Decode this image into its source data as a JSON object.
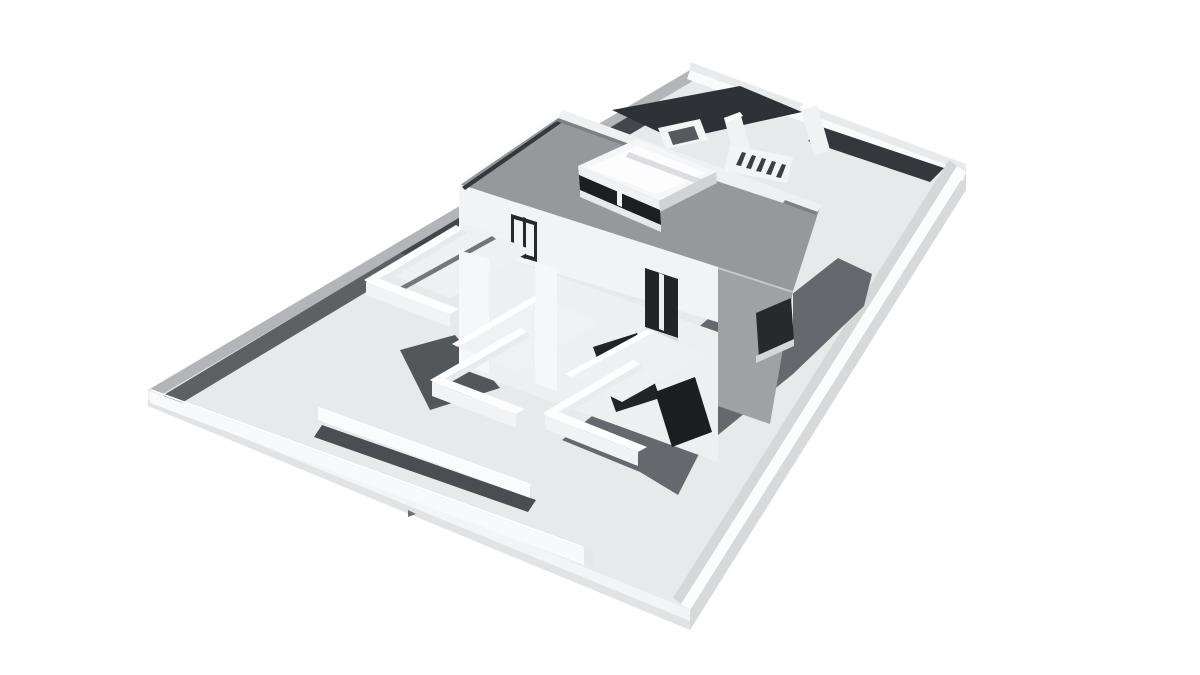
{
  "meta": {
    "title": "3D architectural massing render",
    "type": "grayscale-3d-render",
    "description": "Aerial isometric rendering of a modern two-storey flat-roof house with rooftop terrace box, stepped front balconies, interior courtyard walls, staircase, and a walled rectangular plot on a white background. No text or UI controls are visible."
  },
  "palette": {
    "background": "#ffffff",
    "ground": "#e8e9ea",
    "roof_gray": "#97989b",
    "facade_white": "#f2f3f4",
    "facade_shaded_gray": "#a0a1a5",
    "glass_dark": "#1c1e21",
    "cast_shadow": "#65686c",
    "courtyard_floor_dark": "#2e3135",
    "wall_top_gray": "#b4b5b8"
  },
  "scene": {
    "width": 1200,
    "height": 675,
    "background": "#ffffff",
    "shapes": [
      {
        "n": "plot-slab-side-right",
        "p": "690,610 966,172 966,190 690,630",
        "f": "#d8d9db"
      },
      {
        "n": "plot-slab-side-left",
        "p": "148,390 690,610 690,630 148,406",
        "f": "#f3f4f5"
      },
      {
        "n": "plot-slab-side-left-lip",
        "p": "148,399 690,621 690,630 148,406",
        "f": "#e2e3e5"
      },
      {
        "n": "plot-ground",
        "p": "148,390 690,70 966,172 690,610",
        "f": "#e8e9ea"
      },
      {
        "n": "perimeter-wall-topleft-top",
        "p": "148,390 690,70 703,75 161,395",
        "f": "#b4b5b8"
      },
      {
        "n": "perimeter-wall-topleft-shadow-lower",
        "p": "162,396 400,253 418,261 180,404",
        "f": "#5e6164"
      },
      {
        "n": "perimeter-wall-topleft-shadow-upper",
        "p": "400,253 648,105 666,113 418,261",
        "f": "#43464a"
      },
      {
        "n": "perimeter-wall-topright-top",
        "p": "690,62 966,164 966,172 690,70",
        "f": "#e9eaeb"
      },
      {
        "n": "perimeter-wall-topright-inner-face",
        "p": "690,70 966,172 963,181 687,79",
        "f": "#f9fafb"
      },
      {
        "n": "perimeter-wall-right-top",
        "p": "966,172 690,610 681,604 957,166",
        "f": "#fbfcfc"
      },
      {
        "n": "perimeter-wall-right-inner-face",
        "p": "957,166 681,604 673,598 949,160",
        "f": "#d6d7d9"
      },
      {
        "n": "courtyard-floor-dark-left",
        "p": "612,110 740,86 802,112 676,140",
        "f": "#2e3135"
      },
      {
        "n": "courtyard-floor-dark-right",
        "p": "822,127 944,168 930,182 808,141",
        "f": "#34373b"
      },
      {
        "n": "courtyard-planter-outer",
        "p": "658,128 700,119 708,140 666,149",
        "f": "#f4f5f6"
      },
      {
        "n": "courtyard-planter-inner",
        "p": "668,132 694,126 699,139 673,145",
        "f": "#565a5e"
      },
      {
        "n": "courtyard-partition-wall-a-face",
        "p": "724,118 740,112 754,164 738,170",
        "f": "#f1f2f4"
      },
      {
        "n": "courtyard-partition-wall-a-top",
        "p": "724,118 740,112 743,116 727,122",
        "f": "#ffffff"
      },
      {
        "n": "courtyard-partition-wall-b-face",
        "p": "800,106 816,100 830,150 814,156",
        "f": "#f1f2f4"
      },
      {
        "n": "courtyard-partition-wall-b-top",
        "p": "800,106 816,100 819,104 803,110",
        "f": "#ffffff"
      },
      {
        "n": "house-cast-shadow",
        "p": "562,440 650,370 718,310 791,295 838,258 872,274 864,306 793,374 702,448 678,495 640,472",
        "f": "#65686c"
      },
      {
        "n": "garden-wall-shadow-strip",
        "p": "322,425 536,500 528,512 314,437",
        "f": "#4a4d51"
      },
      {
        "n": "garden-wall-face",
        "p": "318,408 530,485 530,498 318,420",
        "f": "#fafbfc"
      },
      {
        "n": "garden-wall-top",
        "p": "316,406 528,483 532,486 320,409",
        "f": "#ffffff"
      },
      {
        "n": "perimeter-wall-bottomleft-top",
        "p": "148,388 582,546 585,549 151,391",
        "f": "#ffffff"
      },
      {
        "n": "perimeter-wall-bottomleft-face",
        "p": "150,391 584,549 584,565 150,403",
        "f": "#f8f9fa"
      },
      {
        "n": "perimeter-wall-bottomleft-endcap",
        "p": "584,547 594,551 594,566 584,562",
        "f": "#e6e7e9"
      },
      {
        "n": "perimeter-wall-gate-notch",
        "p": "408,510 416,514 408,517",
        "f": "#6e7073"
      },
      {
        "n": "terrace-ground-shadow",
        "p": "400,350 455,335 500,388 430,410",
        "f": "#54575a"
      },
      {
        "n": "house-facade-lower",
        "p": "459,242 718,332 718,462 459,368",
        "f": "#edeff1"
      },
      {
        "n": "house-glazing-ground-left",
        "p": "593,347 637,333 660,398 616,412",
        "f": "#212326"
      },
      {
        "n": "house-glazing-ground-right",
        "p": "655,392 695,377 712,432 672,447",
        "f": "#1b1d20"
      },
      {
        "n": "house-facade-upper",
        "p": "459,184 793,291 793,345 459,244",
        "f": "#f2f3f4"
      },
      {
        "n": "house-side-facade-shaded",
        "p": "718,267 793,291 770,424 718,406",
        "f": "#a0a1a5"
      },
      {
        "n": "house-side-roofline",
        "p": "718,265 793,289 793,293 718,269",
        "f": "#c6c8cb"
      },
      {
        "n": "house-side-window-dark",
        "p": "756,313 791,298 794,341 759,358",
        "f": "#27292c"
      },
      {
        "n": "house-side-window-sill",
        "p": "756,356 794,339 794,346 756,363",
        "f": "#d4d6d8"
      },
      {
        "n": "upper-door-frame",
        "p": "511,214 537,222 537,262 511,254",
        "f": "#26282b"
      },
      {
        "n": "upper-door-glass",
        "p": "514,219 534,225 534,257 514,251",
        "f": "#f2f3f5"
      },
      {
        "n": "upper-door-mullion",
        "p": "523,217 526,218 526,259 523,258",
        "f": "#26282b"
      },
      {
        "n": "upper-window-dark",
        "p": "645,268 678,279 678,338 645,327",
        "f": "#222427"
      },
      {
        "n": "upper-window-mullion",
        "p": "659,273 664,275 664,331 659,329",
        "f": "#eceded"
      },
      {
        "n": "upper-window-sill",
        "p": "645,327 678,338 678,343 645,332",
        "f": "#d9dadc"
      },
      {
        "n": "roof-top",
        "p": "459,184 563,113 820,207 793,291",
        "f": "#97989b"
      },
      {
        "n": "roof-edge-highlight-west",
        "p": "457,182 561,111 564,114 460,185",
        "f": "#fbfcfd"
      },
      {
        "n": "roof-edge-dark-line-west",
        "p": "462,187 564,116 567,119 465,190",
        "f": "#35383c"
      },
      {
        "n": "roof-parapet-northeast",
        "p": "563,110 822,205 816,214 557,119",
        "f": "#eff0f2"
      },
      {
        "n": "roof-parapet-northeast-shadowline",
        "p": "558,118 818,212 816,215 556,121",
        "f": "#7e8084"
      },
      {
        "n": "roof-rim-east-return",
        "p": "660,150 790,193 783,203 653,160",
        "f": "#eef0f2"
      },
      {
        "n": "stairs-base",
        "p": "730,145 793,157 787,183 724,171",
        "f": "#f3f4f6"
      },
      {
        "n": "stairs-step-gap-1",
        "p": "742,152 746,153 741,166 736,165",
        "f": "#3b3e42"
      },
      {
        "n": "stairs-step-gap-2",
        "p": "752,155 756,156 751,169 746,168",
        "f": "#3b3e42"
      },
      {
        "n": "stairs-step-gap-3",
        "p": "762,158 766,159 761,172 756,171",
        "f": "#3b3e42"
      },
      {
        "n": "stairs-step-gap-4",
        "p": "772,161 776,162 771,175 766,174",
        "f": "#3b3e42"
      },
      {
        "n": "stairs-step-gap-5",
        "p": "782,164 786,165 781,178 776,177",
        "f": "#3b3e42"
      },
      {
        "n": "roofbox-parapet-rim",
        "p": "578,166 637,139 716,172 659,201",
        "f": "#f5f6f8"
      },
      {
        "n": "roofbox-terrace-floor",
        "p": "587,168 637,146 706,173 657,194",
        "f": "#fdfdfe"
      },
      {
        "n": "roofbox-floor-ridge",
        "p": "629,152 701,179 698,184 626,157",
        "f": "#dcdde0"
      },
      {
        "n": "roofbox-right-face",
        "p": "659,201 716,172 717,183 660,212",
        "f": "#d2d3d6"
      },
      {
        "n": "roofbox-front-band",
        "p": "578,166 659,201 660,210 579,175",
        "f": "#f0f1f3"
      },
      {
        "n": "roofbox-front-glass",
        "p": "579,175 660,210 661,225 580,190",
        "f": "#1c1e21"
      },
      {
        "n": "roofbox-front-mullion",
        "p": "617,188 622,190 622,207 617,205",
        "f": "#f4f5f6"
      },
      {
        "n": "roofbox-front-sill",
        "p": "580,190 661,225 661,232 580,197",
        "f": "#e7e8ea"
      },
      {
        "n": "terrace1-floor",
        "p": "383,272 465,224 532,250 450,298",
        "f": "#eef0f2"
      },
      {
        "n": "terrace1-floor-shadowline",
        "p": "398,288 492,236 496,239 402,291",
        "f": "#74767a"
      },
      {
        "n": "terrace1-floor-highlight",
        "p": "384,273 460,228 466,231 390,276",
        "f": "#ffffff"
      },
      {
        "n": "terrace1-parapet-left-top",
        "p": "364,280 456,225 463,229 371,284",
        "f": "#fcfdfd"
      },
      {
        "n": "terrace1-parapet-left-inner",
        "p": "371,284 463,229 467,233 375,288",
        "f": "#e7e9eb"
      },
      {
        "n": "terrace1-parapet-front-face",
        "p": "366,282 450,314 450,327 366,295",
        "f": "#f2f3f5"
      },
      {
        "n": "terrace1-parapet-front-top",
        "p": "366,282 450,314 459,309 375,277",
        "f": "#fdfefe"
      },
      {
        "n": "terrace1-blade-wall",
        "p": "459,250 489,259 489,374 459,363",
        "f": "#f6f7f9"
      },
      {
        "n": "terrace2-floor",
        "p": "455,345 540,296 601,322 516,372",
        "f": "#f0f1f3"
      },
      {
        "n": "terrace2-floor-highlight",
        "p": "452,344 536,295 542,298 458,347",
        "f": "#ffffff"
      },
      {
        "n": "terrace2-parapet-left-top",
        "p": "430,380 520,328 527,332 437,384",
        "f": "#fcfdfd"
      },
      {
        "n": "terrace2-parapet-left-inner",
        "p": "437,384 527,332 531,336 441,388",
        "f": "#e8eaec"
      },
      {
        "n": "terrace2-parapet-front-face",
        "p": "432,382 516,414 516,428 432,396",
        "f": "#f1f3f5"
      },
      {
        "n": "terrace2-parapet-front-top",
        "p": "432,382 516,414 525,409 441,377",
        "f": "#fdfdfe"
      },
      {
        "n": "terrace2-blade-wall",
        "p": "535,262 557,269 557,391 535,383",
        "f": "#f6f7f9"
      },
      {
        "n": "terrace3-floor",
        "p": "568,375 652,330 706,355 622,402",
        "f": "#eef0f2"
      },
      {
        "n": "terrace3-floor-highlight",
        "p": "565,374 648,329 654,332 571,377",
        "f": "#ffffff"
      },
      {
        "n": "terrace3-parapet-left-top",
        "p": "543,413 633,360 640,364 550,417",
        "f": "#fcfdfd"
      },
      {
        "n": "terrace3-parapet-left-inner",
        "p": "550,417 640,364 644,368 554,421",
        "f": "#e9ebed"
      },
      {
        "n": "terrace3-parapet-front-face",
        "p": "545,415 638,452 638,466 545,429",
        "f": "#f1f2f4"
      },
      {
        "n": "terrace3-parapet-front-top",
        "p": "545,415 638,452 647,447 554,410",
        "f": "#fdfefe"
      }
    ]
  }
}
